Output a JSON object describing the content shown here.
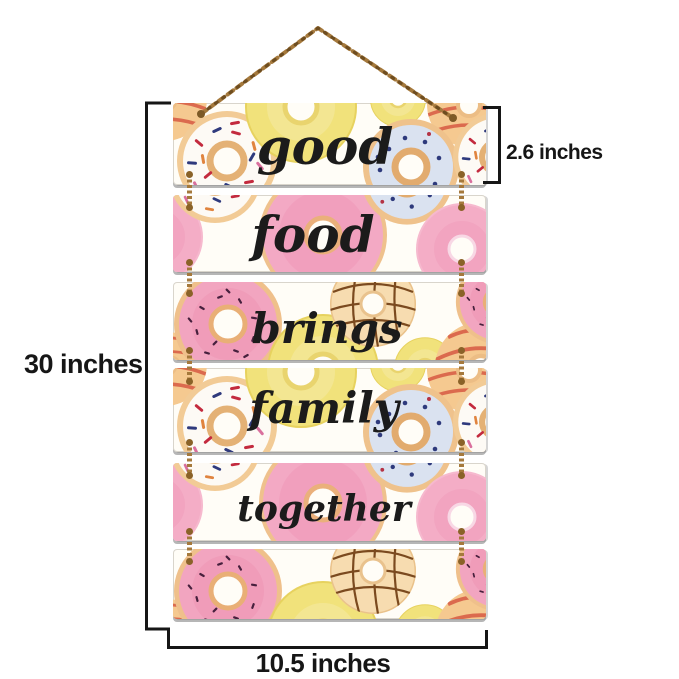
{
  "sign": {
    "planks": [
      {
        "word": "good"
      },
      {
        "word": "food"
      },
      {
        "word": "brings"
      },
      {
        "word": "family"
      },
      {
        "word": "together"
      },
      {
        "word": ""
      }
    ]
  },
  "dimensions": {
    "height_label": "30 inches",
    "plank_height_label": "2.6 inches",
    "width_label": "10.5 inches"
  },
  "colors": {
    "dimension_line": "#161616",
    "word_text": "#1b1b1b",
    "chain_gold": "#a5793c",
    "plank_background": "#fffdf7",
    "pink_frosting": "#f3a9c4",
    "yellow_frosting": "#f1e27b",
    "blue_frosting": "#dfe6f2",
    "white_frosting": "#fdfaf5",
    "dough": "#efc28c",
    "stripe_red": "#db6a4e",
    "crosshatch_brown": "#7b4a1f"
  }
}
